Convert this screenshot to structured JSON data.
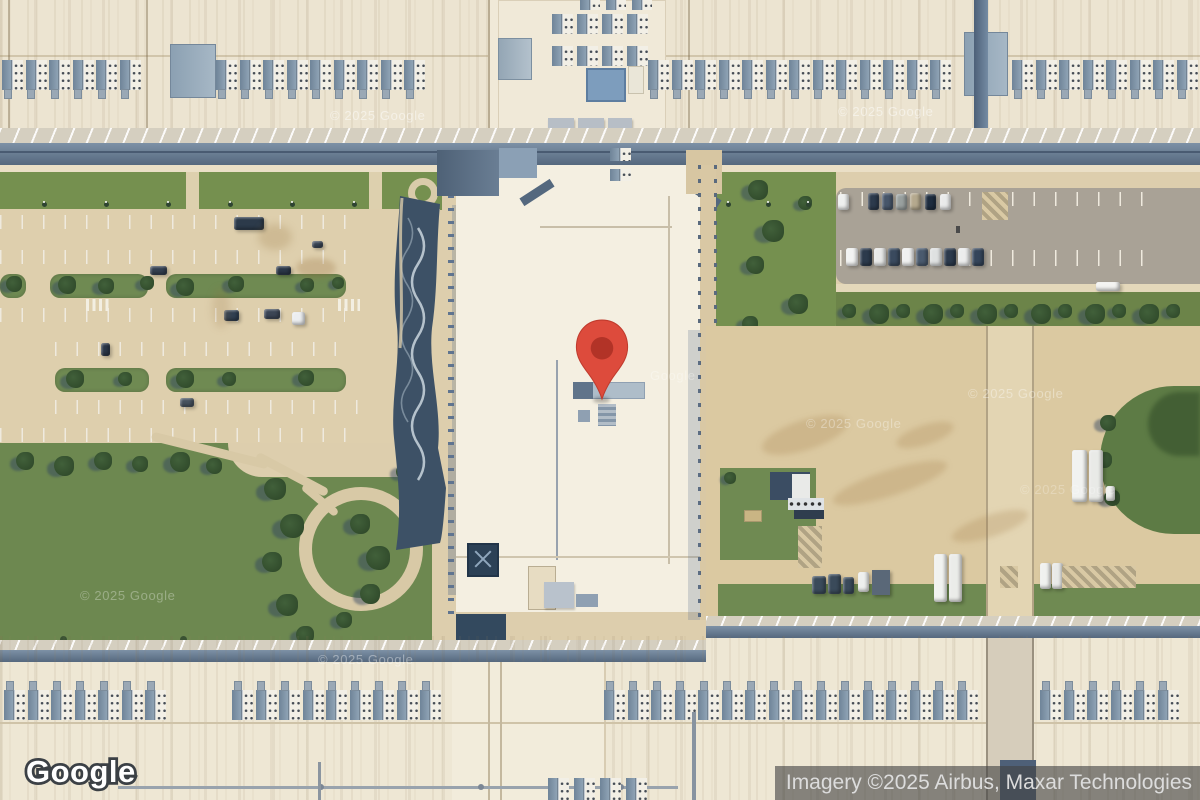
{
  "map": {
    "watermark": "© 2025 Google",
    "watermark_partial": "Google"
  },
  "branding": {
    "logo": "Google"
  },
  "attribution": {
    "text": "Imagery ©2025 Airbus, Maxar Technologies"
  },
  "marker": {
    "color": "#dd4b3c",
    "inner_color": "#b23327"
  },
  "colors": {
    "roof_cream": "#ece4d1",
    "lawn_green": "#6d8850",
    "parking_asphalt": "#a9a296",
    "yard_tan": "#dbc9a1",
    "pond_water": "#3d5166",
    "hvac_steel": "#7e93a8",
    "attribution_bar": "rgba(68,68,68,0.62)",
    "attribution_text": "#dcdcdc"
  }
}
